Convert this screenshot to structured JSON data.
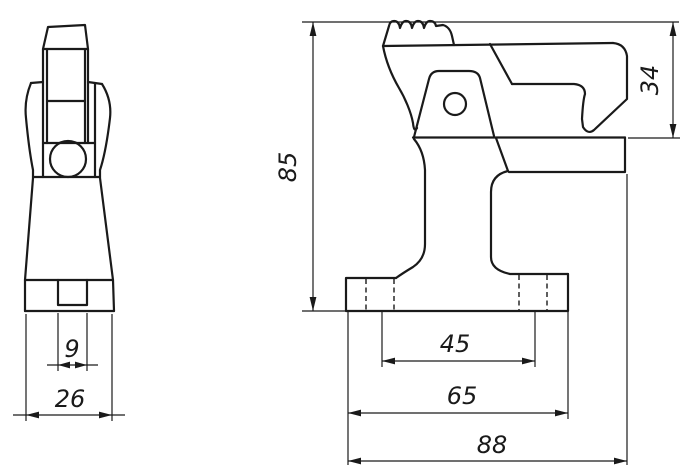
{
  "colors": {
    "background": "#ffffff",
    "line": "#1a1a1a"
  },
  "front_view": {
    "dim_slot_width": "9",
    "dim_overall_width": "26"
  },
  "side_view": {
    "dim_overall_height": "85",
    "dim_jaw_opening": "34",
    "dim_slot_spacing": "45",
    "dim_base_width": "65",
    "dim_overall_length": "88"
  }
}
